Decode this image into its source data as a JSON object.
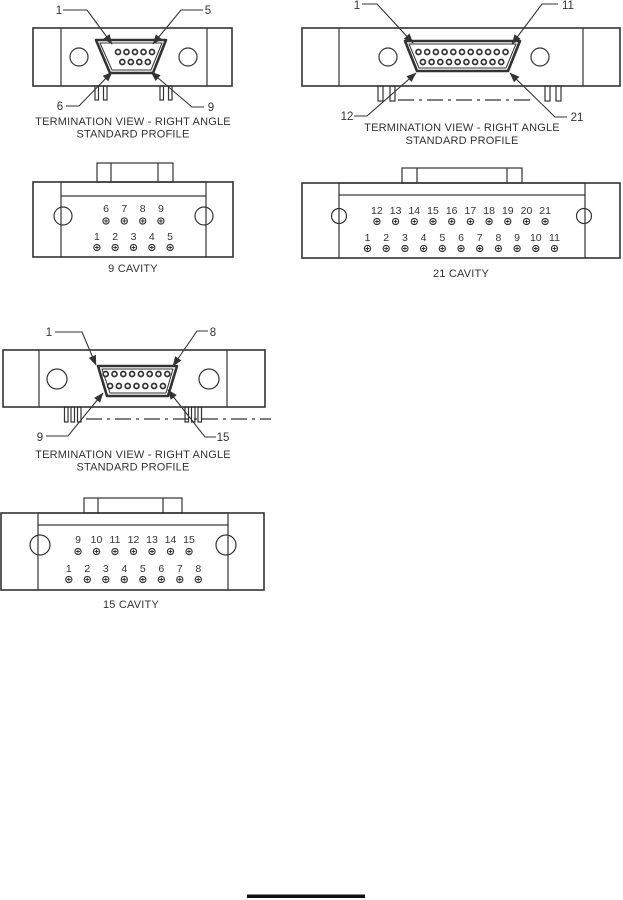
{
  "colors": {
    "line": "#333333",
    "text": "#333333",
    "footer_rule": "#111111"
  },
  "diagrams": {
    "term9": {
      "corner_labels": {
        "tl": "1",
        "tr": "5",
        "bl": "6",
        "br": "9"
      },
      "caption": [
        "TERMINATION VIEW - RIGHT ANGLE",
        "STANDARD PROFILE"
      ],
      "pins": {
        "top": 5,
        "bottom": 4
      }
    },
    "term21": {
      "corner_labels": {
        "tl": "1",
        "tr": "11",
        "bl": "12",
        "br": "21"
      },
      "caption": [
        "TERMINATION VIEW - RIGHT ANGLE",
        "STANDARD PROFILE"
      ],
      "pins": {
        "top": 11,
        "bottom": 10
      }
    },
    "term15": {
      "corner_labels": {
        "tl": "1",
        "tr": "8",
        "bl": "9",
        "br": "15"
      },
      "caption": [
        "TERMINATION VIEW - RIGHT ANGLE",
        "STANDARD PROFILE"
      ],
      "pins": {
        "top": 8,
        "bottom": 7
      }
    },
    "cav9": {
      "title": "9 CAVITY",
      "top_row": [
        "6",
        "7",
        "8",
        "9"
      ],
      "bottom_row": [
        "1",
        "2",
        "3",
        "4",
        "5"
      ]
    },
    "cav21": {
      "title": "21 CAVITY",
      "top_row": [
        "12",
        "13",
        "14",
        "15",
        "16",
        "17",
        "18",
        "19",
        "20",
        "21"
      ],
      "bottom_row": [
        "1",
        "2",
        "3",
        "4",
        "5",
        "6",
        "7",
        "8",
        "9",
        "10",
        "11"
      ]
    },
    "cav15": {
      "title": "15 CAVITY",
      "top_row": [
        "9",
        "10",
        "11",
        "12",
        "13",
        "14",
        "15"
      ],
      "bottom_row": [
        "1",
        "2",
        "3",
        "4",
        "5",
        "6",
        "7",
        "8"
      ]
    }
  }
}
